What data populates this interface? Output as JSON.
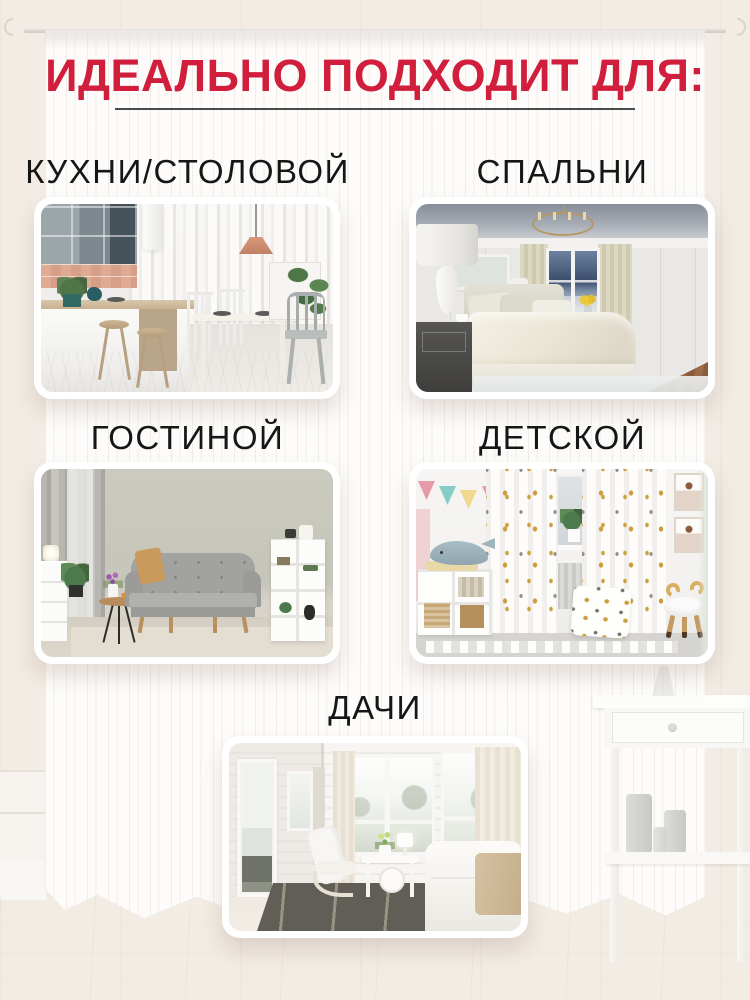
{
  "header": {
    "title": "ИДЕАЛЬНО ПОДХОДИТ ДЛЯ:"
  },
  "sections": [
    {
      "id": "kitchen-dining",
      "label": "КУХНИ/СТОЛОВОЙ"
    },
    {
      "id": "bedroom",
      "label": "СПАЛЬНИ"
    },
    {
      "id": "living-room",
      "label": "ГОСТИНОЙ"
    },
    {
      "id": "kids-room",
      "label": "ДЕТСКОЙ"
    },
    {
      "id": "dacha",
      "label": "ДАЧИ"
    }
  ],
  "colors": {
    "accent_red": "#d11e3c",
    "title_underline": "#4c4c4c",
    "label_text": "#161616",
    "backdrop_wall": "#f2ece4",
    "backdrop_floor": "#f3e9e1",
    "curtain_white": "#fdfcfb"
  }
}
